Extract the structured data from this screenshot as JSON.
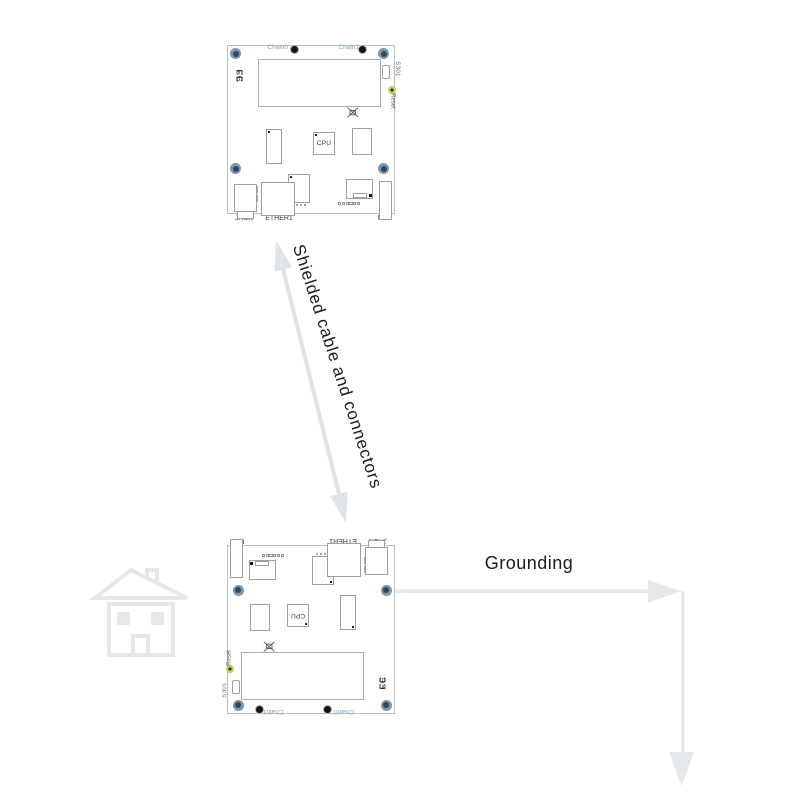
{
  "diagram": {
    "shielded_label": "Shielded cable and connectors",
    "grounding_label": "Grounding"
  },
  "board": {
    "chain0": "Chain0",
    "chain1": "Chain1",
    "fcc_mark": "FC",
    "ce_mark": "CE",
    "s301": "S301",
    "reset": "Reset",
    "cpu": "CPU",
    "jack": "JACK",
    "ether1": "ETHER1",
    "usb": "USB"
  },
  "colors": {
    "ink": "#1c1c1c",
    "arrow_gray": "#dfe3e5",
    "grounding_gray": "#e5e8ea",
    "house_gray": "#e4e8eb",
    "screw_ring": "#7e96a8",
    "screw_core": "#2b4962",
    "chain_label": "#8aa3b2",
    "reset_led": "#c2d153"
  }
}
